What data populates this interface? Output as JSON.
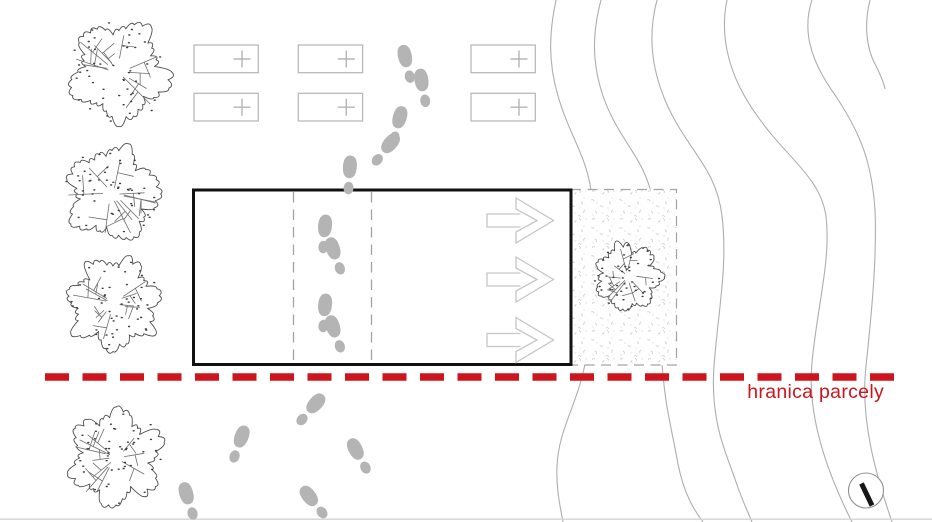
{
  "boundary": {
    "label": "hranica parcely"
  },
  "colors": {
    "background": "#ffffff",
    "boundary_red": "#ce141c",
    "contour_gray": "#aeaeae",
    "footprint_gray": "#b4b4b4",
    "parking_gray": "#b5b5b5",
    "dashed_guide_gray": "#a3a3a3",
    "arrow_gray": "#c6c6c6",
    "building_outline": "#111111",
    "tree_outline": "#4d4d4d"
  },
  "icons": {
    "parking_marker": "plus-icon",
    "walking_path": "footprint-icon",
    "flow_direction": "arrow-right-icon",
    "north_indicator": "compass-needle-icon"
  },
  "features": {
    "parking_space_count": 6,
    "tree_count": 5,
    "direction_arrow_count": 3
  }
}
